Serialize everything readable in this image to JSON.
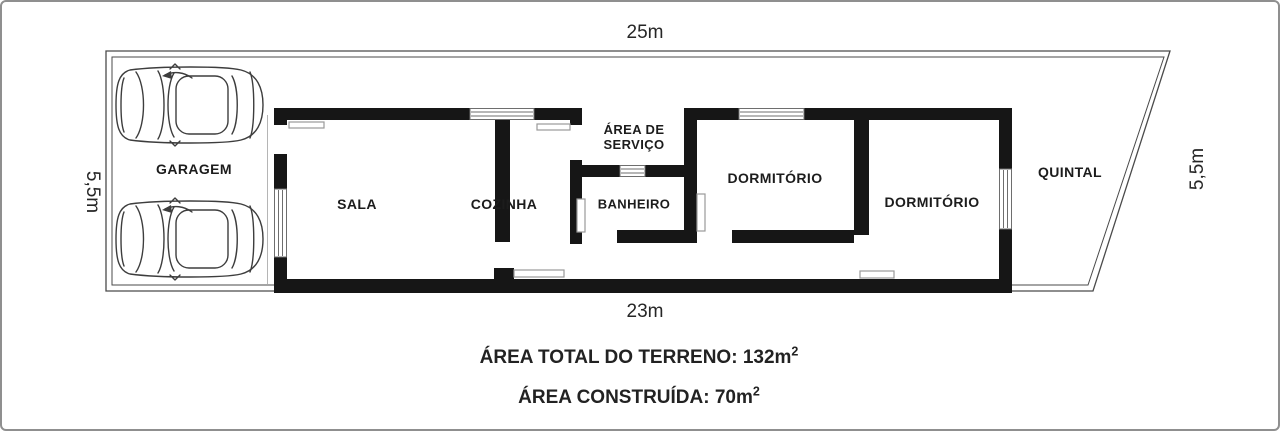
{
  "plan": {
    "title_hint": "residential lot floor plan",
    "dimensions": {
      "top": "25m",
      "bottom": "23m",
      "left": "5,5m",
      "right": "5,5m"
    },
    "rooms": {
      "garage": "GARAGEM",
      "living": "SALA",
      "kitchen": "COZINHA",
      "service_area": "ÁREA DE SERVIÇO",
      "bathroom": "BANHEIRO",
      "bedroom1": "DORMITÓRIO",
      "bedroom2": "DORMITÓRIO",
      "backyard": "QUINTAL"
    },
    "summary": {
      "total_area_label": "ÁREA TOTAL DO TERRENO: 132m",
      "total_area_sup": "2",
      "built_area_label": "ÁREA CONSTRUÍDA: 70m",
      "built_area_sup": "2"
    },
    "icons": {
      "car": "car-top-view-icon"
    },
    "colors": {
      "wall": "#161616",
      "boundary_line": "#4a4a4a",
      "window_line": "#6e6e6e",
      "door_leaf_line": "#9a9a9a",
      "background": "#ffffff"
    }
  }
}
